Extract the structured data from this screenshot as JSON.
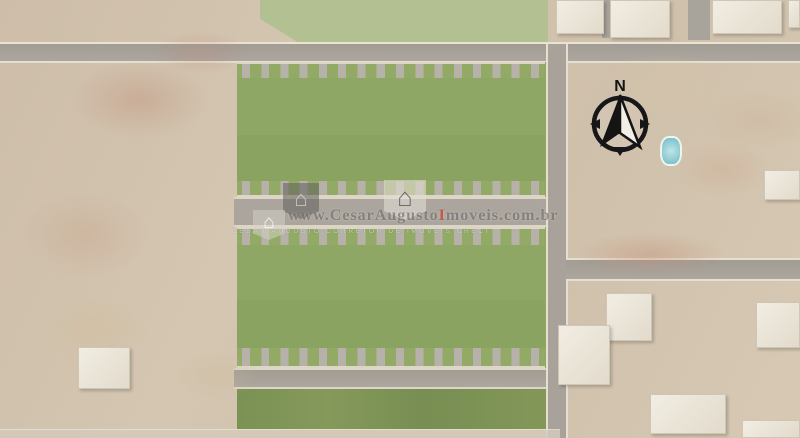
{
  "watermark": {
    "site_prefix": "www.",
    "site_name": "CesarAugusto",
    "site_accent": "I",
    "site_suffix": "moveis.com.br",
    "tagline": "CESAR AUGUSTO CORRETOR DE IMOVEIS CRECI",
    "accent_color": "#c13a2a"
  },
  "compass": {
    "north_label": "N"
  },
  "development": {
    "rows": [
      {
        "name": "row-1",
        "front": "top",
        "lots": [
          "08B",
          "08A",
          "07B",
          "07A",
          "06B",
          "06A",
          "05B",
          "05A",
          "04B",
          "04A",
          "03B",
          "03A",
          "02B",
          "02A",
          "01B",
          "01A"
        ]
      },
      {
        "name": "row-2",
        "front": "bottom",
        "lots": [
          "16A",
          "16B",
          "15A",
          "15B",
          "14A",
          "14B",
          "13A",
          "13B",
          "12A",
          "12B",
          "11A",
          "11B",
          "10A",
          "10B",
          "09A",
          "09B"
        ]
      },
      {
        "name": "row-3",
        "front": "top",
        "lots": [
          "24B",
          "24A",
          "23B",
          "23A",
          "22B",
          "22A",
          "21B",
          "21A",
          "20B",
          "20A",
          "19B",
          "19A",
          "18B",
          "18A",
          "17B",
          "17A"
        ]
      },
      {
        "name": "row-4",
        "front": "bottom",
        "lots": [
          "32A",
          "32B",
          "31A",
          "31B",
          "30A",
          "30B",
          "29A",
          "29B",
          "28A",
          "28B",
          "27A",
          "27B",
          "26A",
          "26B",
          "25A",
          "25B"
        ]
      }
    ]
  },
  "scenery": {
    "trees": [
      [
        80,
        16,
        16,
        1
      ],
      [
        152,
        13,
        13,
        1
      ],
      [
        108,
        68,
        24,
        1
      ],
      [
        86,
        92,
        14,
        1
      ],
      [
        22,
        112,
        15,
        2
      ],
      [
        94,
        128,
        13,
        2
      ],
      [
        140,
        110,
        9,
        0
      ],
      [
        200,
        120,
        9,
        1
      ],
      [
        232,
        104,
        10,
        1
      ],
      [
        35,
        180,
        11,
        1
      ],
      [
        152,
        205,
        9,
        0
      ],
      [
        58,
        236,
        11,
        1
      ],
      [
        14,
        262,
        13,
        2
      ],
      [
        122,
        266,
        9,
        0
      ],
      [
        188,
        300,
        11,
        1
      ],
      [
        72,
        300,
        9,
        1
      ],
      [
        225,
        260,
        8,
        2
      ],
      [
        230,
        170,
        8,
        0
      ],
      [
        236,
        248,
        9,
        1
      ],
      [
        20,
        310,
        20,
        2
      ],
      [
        55,
        325,
        18,
        1
      ],
      [
        95,
        310,
        17,
        2
      ],
      [
        135,
        320,
        18,
        2
      ],
      [
        175,
        315,
        16,
        1
      ],
      [
        215,
        325,
        16,
        2
      ],
      [
        10,
        360,
        18,
        1
      ],
      [
        48,
        370,
        17,
        2
      ],
      [
        90,
        385,
        18,
        1
      ],
      [
        130,
        370,
        16,
        2
      ],
      [
        170,
        375,
        17,
        2
      ],
      [
        210,
        370,
        15,
        1
      ],
      [
        25,
        410,
        17,
        2
      ],
      [
        70,
        415,
        16,
        1
      ],
      [
        115,
        418,
        17,
        2
      ],
      [
        160,
        412,
        15,
        1
      ],
      [
        205,
        415,
        16,
        2
      ],
      [
        235,
        390,
        13,
        1
      ],
      [
        60,
        345,
        14,
        1
      ],
      [
        150,
        345,
        13,
        2
      ],
      [
        232,
        345,
        12,
        2
      ],
      [
        195,
        430,
        13,
        2
      ],
      [
        110,
        435,
        14,
        1
      ],
      [
        302,
        16,
        14,
        3
      ],
      [
        330,
        30,
        12,
        1
      ],
      [
        358,
        12,
        12,
        3
      ],
      [
        388,
        28,
        13,
        1
      ],
      [
        418,
        12,
        13,
        3
      ],
      [
        452,
        26,
        14,
        1
      ],
      [
        486,
        12,
        13,
        3
      ],
      [
        514,
        28,
        12,
        1
      ],
      [
        538,
        14,
        11,
        3
      ],
      [
        286,
        34,
        9,
        1
      ],
      [
        440,
        34,
        10,
        3
      ],
      [
        470,
        6,
        9,
        1
      ],
      [
        350,
        33,
        9,
        3
      ],
      [
        530,
        34,
        8,
        3
      ],
      [
        582,
        196,
        13,
        1
      ],
      [
        606,
        186,
        11,
        3
      ],
      [
        632,
        200,
        12,
        1
      ],
      [
        660,
        190,
        11,
        2
      ],
      [
        688,
        206,
        12,
        1
      ],
      [
        716,
        190,
        13,
        2
      ],
      [
        746,
        206,
        11,
        1
      ],
      [
        776,
        193,
        12,
        2
      ],
      [
        798,
        212,
        9,
        1
      ],
      [
        652,
        232,
        9,
        3
      ],
      [
        702,
        236,
        10,
        2
      ],
      [
        762,
        236,
        9,
        1
      ],
      [
        795,
        252,
        11,
        2
      ],
      [
        742,
        152,
        9,
        3
      ],
      [
        772,
        162,
        10,
        1
      ],
      [
        718,
        170,
        8,
        2
      ],
      [
        576,
        232,
        8,
        1
      ],
      [
        610,
        150,
        9,
        1
      ],
      [
        640,
        120,
        8,
        3
      ],
      [
        588,
        300,
        13,
        2
      ],
      [
        622,
        342,
        15,
        1
      ],
      [
        592,
        392,
        12,
        2
      ],
      [
        642,
        372,
        11,
        2
      ],
      [
        682,
        332,
        13,
        1
      ],
      [
        702,
        302,
        11,
        2
      ],
      [
        732,
        362,
        13,
        2
      ],
      [
        772,
        332,
        12,
        1
      ],
      [
        702,
        422,
        11,
        1
      ],
      [
        762,
        402,
        12,
        2
      ],
      [
        662,
        427,
        10,
        2
      ],
      [
        797,
        382,
        11,
        2
      ],
      [
        627,
        302,
        9,
        1
      ],
      [
        575,
        430,
        10,
        1
      ],
      [
        252,
        408,
        14,
        1
      ],
      [
        282,
        402,
        12,
        2
      ],
      [
        312,
        410,
        13,
        1
      ],
      [
        342,
        400,
        12,
        2
      ],
      [
        372,
        408,
        13,
        1
      ],
      [
        402,
        402,
        12,
        2
      ],
      [
        432,
        410,
        13,
        1
      ],
      [
        462,
        402,
        12,
        2
      ],
      [
        492,
        408,
        13,
        1
      ],
      [
        522,
        402,
        12,
        2
      ],
      [
        540,
        413,
        10,
        1
      ]
    ],
    "patches": [
      [
        70,
        60,
        140,
        80,
        "rgba(190,140,118,0.38)"
      ],
      [
        150,
        30,
        100,
        45,
        "rgba(190,140,118,0.30)"
      ],
      [
        20,
        190,
        130,
        90,
        "rgba(198,158,132,0.32)"
      ],
      [
        575,
        232,
        150,
        45,
        "rgba(196,144,120,0.42)"
      ],
      [
        672,
        142,
        100,
        55,
        "rgba(204,162,138,0.32)"
      ],
      [
        40,
        295,
        110,
        70,
        "rgba(210,190,158,0.55)"
      ],
      [
        596,
        52,
        140,
        70,
        "rgba(214,196,170,0.45)"
      ],
      [
        700,
        90,
        120,
        60,
        "rgba(200,170,146,0.30)"
      ],
      [
        170,
        350,
        90,
        50,
        "rgba(206,186,156,0.35)"
      ]
    ],
    "roofs": [
      [
        556,
        0,
        48,
        34
      ],
      [
        610,
        0,
        60,
        38
      ],
      [
        712,
        0,
        70,
        34
      ],
      [
        788,
        0,
        12,
        28
      ],
      [
        606,
        293,
        46,
        48
      ],
      [
        558,
        325,
        52,
        60
      ],
      [
        650,
        394,
        76,
        40
      ],
      [
        756,
        302,
        44,
        46
      ],
      [
        742,
        420,
        58,
        18
      ],
      [
        78,
        347,
        52,
        42
      ],
      [
        764,
        170,
        36,
        30
      ]
    ],
    "minor_roads": [
      [
        602,
        0,
        8,
        38
      ],
      [
        688,
        0,
        22,
        40
      ]
    ],
    "cars": [
      [
        214,
        45,
        13,
        7,
        "#4c8b50"
      ],
      [
        633,
        45,
        12,
        6,
        "#efeee8"
      ],
      [
        262,
        66,
        6,
        11,
        "#f0efe9"
      ],
      [
        306,
        66,
        6,
        11,
        "#f0efe9"
      ],
      [
        438,
        66,
        6,
        11,
        "#30302f"
      ],
      [
        506,
        66,
        6,
        11,
        "#3a3a3c"
      ],
      [
        273,
        183,
        6,
        12,
        "#f0efe9"
      ],
      [
        416,
        183,
        6,
        12,
        "#35353a"
      ],
      [
        240,
        201,
        11,
        6,
        "#f0efe9"
      ],
      [
        305,
        202,
        11,
        6,
        "#f0efe9"
      ],
      [
        497,
        201,
        11,
        6,
        "#f0efe9"
      ],
      [
        365,
        232,
        6,
        12,
        "#2e2e2e"
      ],
      [
        447,
        230,
        6,
        12,
        "#dcc22f"
      ],
      [
        501,
        230,
        6,
        12,
        "#ae3024"
      ],
      [
        317,
        350,
        6,
        12,
        "#f0efe9"
      ],
      [
        337,
        350,
        6,
        12,
        "#f0efe9"
      ],
      [
        389,
        350,
        6,
        12,
        "#f0efe9"
      ],
      [
        407,
        349,
        6,
        12,
        "#3f7a44"
      ],
      [
        464,
        350,
        6,
        12,
        "#a32c22"
      ],
      [
        482,
        350,
        6,
        12,
        "#2c4f8f"
      ],
      [
        383,
        372,
        12,
        6,
        "#efede6"
      ],
      [
        502,
        371,
        12,
        6,
        "#efede6"
      ]
    ]
  }
}
